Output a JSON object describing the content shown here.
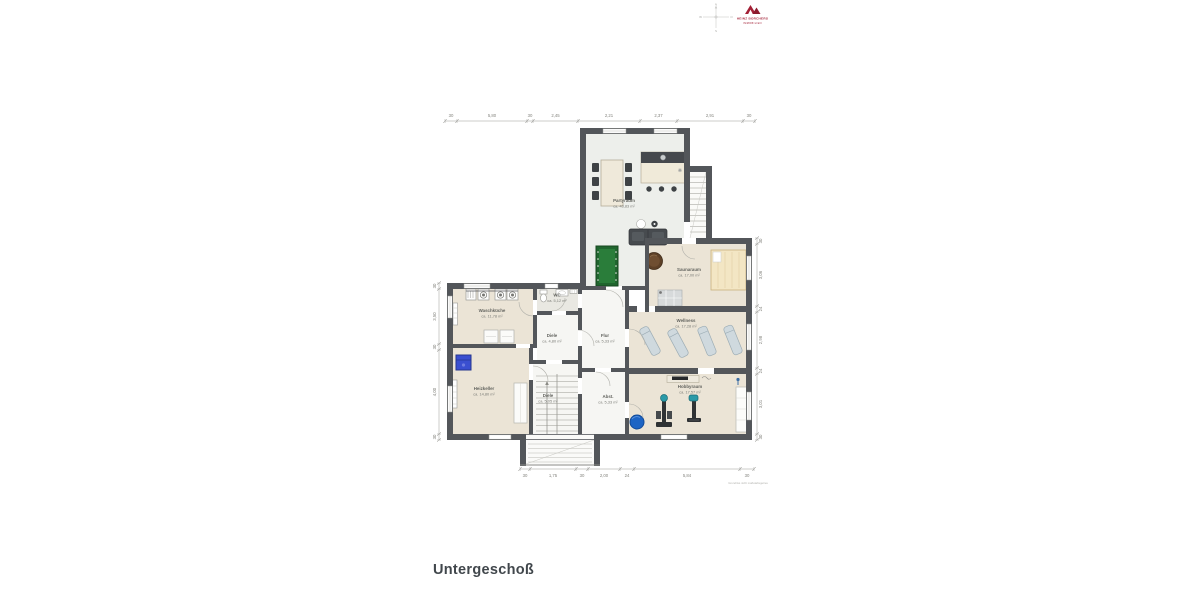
{
  "title": "Untergeschoß",
  "caption": "Grundriss nicht maßstabsgetreu",
  "logo": {
    "line1": "HEINZ BORCHERS",
    "line2": "IMMOBILIEN",
    "accent": "#a32036"
  },
  "compass": {
    "n": "N",
    "e": "O",
    "s": "S",
    "w": "W"
  },
  "rooms": [
    {
      "id": "partyraum",
      "name": "Partyraum",
      "area": "ca. 43,83 m²"
    },
    {
      "id": "saunaraum",
      "name": "Saunaraum",
      "area": "ca. 17,00 m²"
    },
    {
      "id": "wellness",
      "name": "Wellness",
      "area": "ca. 17,28 m²"
    },
    {
      "id": "hobbyraum",
      "name": "Hobbyraum",
      "area": "ca. 17,57 m²"
    },
    {
      "id": "waschkueche",
      "name": "Waschküche",
      "area": "ca. 11,78 m²"
    },
    {
      "id": "wc",
      "name": "WC",
      "area": "ca. 5,12 m²"
    },
    {
      "id": "diele-og",
      "name": "Diele",
      "area": "ca. 4,80 m²"
    },
    {
      "id": "flur",
      "name": "Flur",
      "area": "ca. 5,33 m²"
    },
    {
      "id": "heizkeller",
      "name": "Heizkeller",
      "area": "ca. 14,80 m²"
    },
    {
      "id": "diele-ug",
      "name": "Diele",
      "area": "ca. 5,05 m²"
    },
    {
      "id": "abstellraum",
      "name": "Abst.",
      "area": "ca. 5,33 m²"
    }
  ],
  "dims": {
    "top": [
      "30",
      "5,80",
      "30",
      "2,45",
      "2,21",
      "2,37",
      "2,91",
      "30"
    ],
    "left": [
      "30",
      "3,50",
      "30",
      "4,00",
      "30"
    ],
    "right": [
      "30",
      "3,06",
      "24",
      "2,98",
      "24",
      "3,01",
      "30"
    ],
    "bottom": [
      "30",
      "1,75",
      "30",
      "2,00",
      "24",
      "5,84",
      "30"
    ]
  },
  "colors": {
    "wall": "#53565a",
    "room_beige": "#ebe4d6",
    "party_floor": "#edefeb",
    "corridor": "#f6f6f3",
    "billiard_green": "#20652e",
    "tub_brown": "#5d4027",
    "ball_blue": "#1d64c4",
    "boiler_blue": "#3a4fd0",
    "lounger_blue": "#cfd9de"
  }
}
